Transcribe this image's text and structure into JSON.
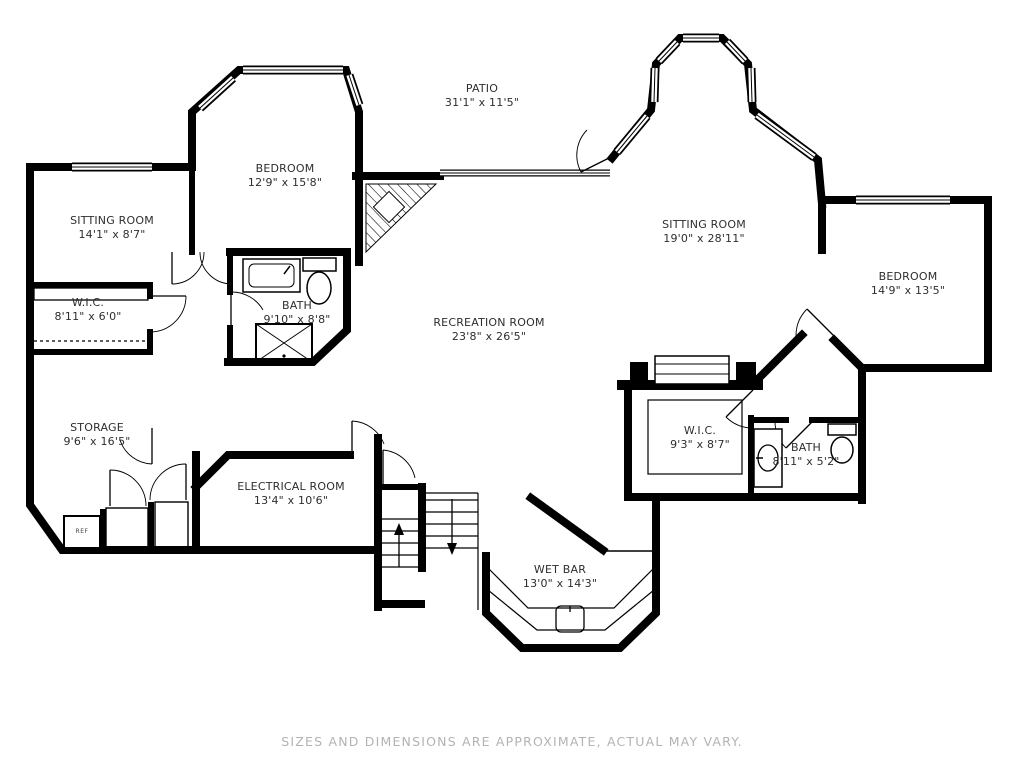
{
  "page": {
    "background": "#ffffff",
    "wall_color": "#000000",
    "label_color": "#2e2e2e",
    "disclaimer_color": "#b3b3b3"
  },
  "disclaimer": "SIZES AND DIMENSIONS ARE APPROXIMATE, ACTUAL MAY VARY.",
  "ref_label": "REF",
  "rooms": [
    {
      "name": "PATIO",
      "dims": "31'1\" x 11'5\""
    },
    {
      "name": "BEDROOM",
      "dims": "12'9\" x 15'8\""
    },
    {
      "name": "SITTING ROOM",
      "dims": "14'1\" x 8'7\""
    },
    {
      "name": "W.I.C.",
      "dims": "8'11\" x 6'0\""
    },
    {
      "name": "BATH",
      "dims": "9'10\" x 8'8\""
    },
    {
      "name": "RECREATION ROOM",
      "dims": "23'8\" x 26'5\""
    },
    {
      "name": "SITTING ROOM",
      "dims": "19'0\" x 28'11\""
    },
    {
      "name": "BEDROOM",
      "dims": "14'9\" x 13'5\""
    },
    {
      "name": "STORAGE",
      "dims": "9'6\" x 16'5\""
    },
    {
      "name": "ELECTRICAL ROOM",
      "dims": "13'4\" x 10'6\""
    },
    {
      "name": "W.I.C.",
      "dims": "9'3\" x 8'7\""
    },
    {
      "name": "BATH",
      "dims": "8'11\" x 5'2\""
    },
    {
      "name": "WET BAR",
      "dims": "13'0\" x 14'3\""
    }
  ]
}
